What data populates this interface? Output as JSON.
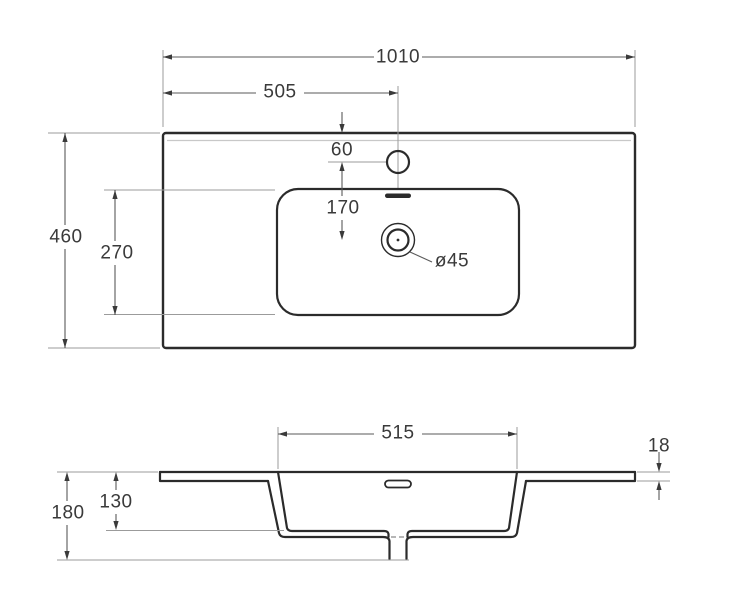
{
  "drawing": {
    "title": "washbasin-dimensional-drawing",
    "top_view": {
      "overall_width": "1010",
      "faucet_center_offset": "505",
      "faucet_edge_distance": "60",
      "faucet_to_drain": "170",
      "overall_depth": "460",
      "basin_opening_depth": "270",
      "drain_diameter": "ø45"
    },
    "section_view": {
      "basin_opening_width": "515",
      "countertop_thickness": "18",
      "overall_height": "180",
      "basin_inner_depth": "130"
    },
    "colors": {
      "outline": "#2b2b2b",
      "dimension_line": "#5a5a5a",
      "extension_line": "#9b9b9b",
      "label_text": "#3a3a3a",
      "soft_edge": "#c8c8c8",
      "background": "#ffffff"
    }
  }
}
